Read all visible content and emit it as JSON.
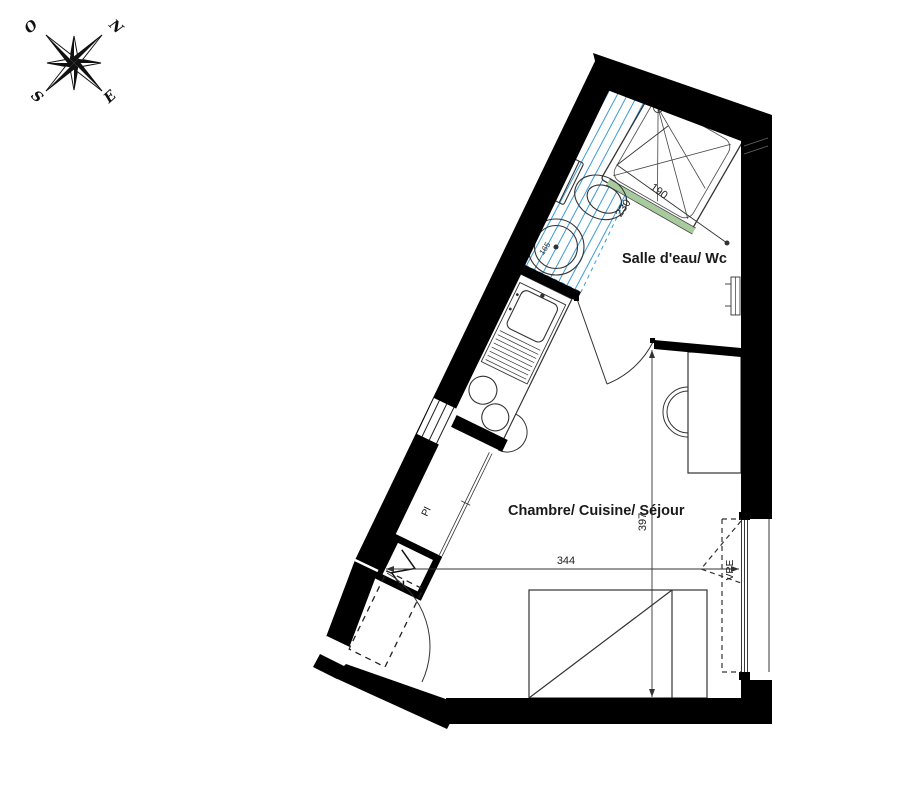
{
  "compass": {
    "north": "N",
    "west": "O",
    "south": "S",
    "east": "E"
  },
  "rooms": {
    "bathroom_label": "Salle d'eau/ Wc",
    "main_label": "Chambre/ Cuisine/ Séjour"
  },
  "dimensions": {
    "bathroom_length": "230",
    "bathroom_width": "190",
    "room_width": "344",
    "room_depth": "397",
    "hatch_zone": "165"
  },
  "annotations": {
    "closet": "Pl",
    "roller_shutter": "VRE"
  },
  "colors": {
    "wall": "#000000",
    "accessibility_hatch": "#3d9bd5",
    "shower_glass": "#a8cb9e",
    "shutter_label": "#3d9bd5"
  }
}
